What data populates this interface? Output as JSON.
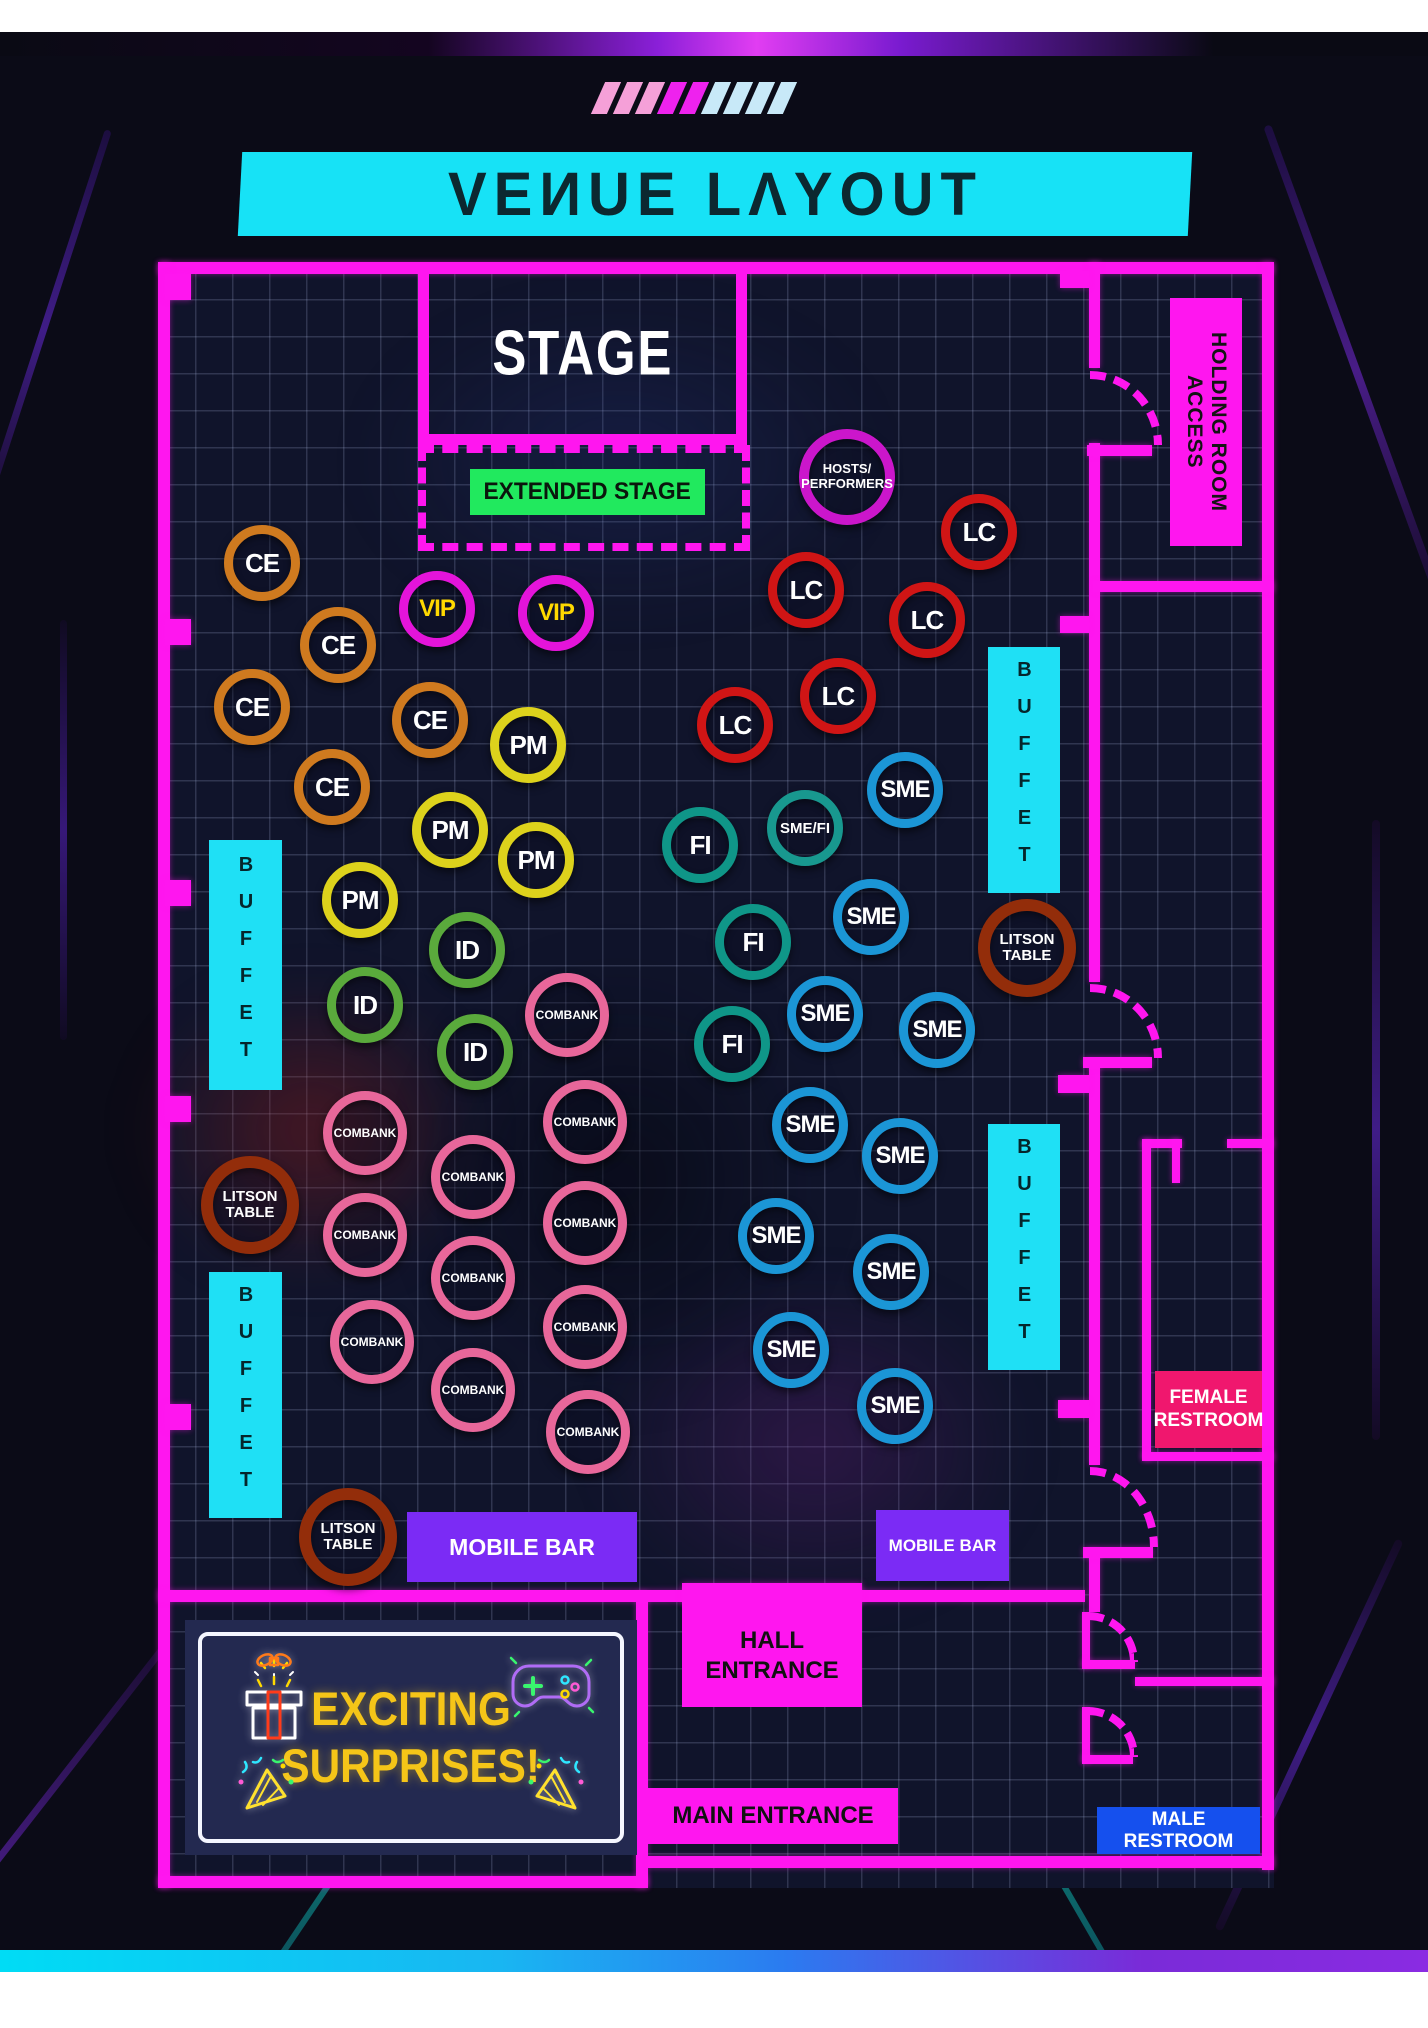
{
  "header": {
    "title": "VEИUE LΛYOUT",
    "slash_colors": [
      "#f5a0d8",
      "#f5a0d8",
      "#f5a0d8",
      "#ee22ee",
      "#ee22ee",
      "#c8e9f8",
      "#c8e9f8",
      "#c8e9f8",
      "#c8e9f8"
    ]
  },
  "colors": {
    "wall": "#ff16ef",
    "buffet_cyan": "#1fe0f5",
    "stage_green": "#21e95e",
    "mobile_bar_purple": "#7b2bf5",
    "female_pink": "#f0176e",
    "male_blue": "#1550ee",
    "banner_yellow": "#f5c518"
  },
  "venue": {
    "stage_label": "STAGE",
    "extended_stage_label": "EXTENDED STAGE",
    "holding_room_label": "HOLDING ROOM ACCESS",
    "buffet_label": "BUFFET",
    "mobile_bar_label": "MOBILE BAR",
    "hall_entrance_label": "HALL\nENTRANCE",
    "main_entrance_label": "MAIN ENTRANCE",
    "female_restroom_label": "FEMALE\nRESTROOM",
    "male_restroom_label": "MALE RESTROOM"
  },
  "banner": {
    "line1": "EXCITING",
    "line2": "SURPRISES!"
  },
  "tables": [
    {
      "type": "ce",
      "label": "CE",
      "x": 262,
      "y": 563
    },
    {
      "type": "ce",
      "label": "CE",
      "x": 338,
      "y": 645
    },
    {
      "type": "ce",
      "label": "CE",
      "x": 252,
      "y": 707
    },
    {
      "type": "ce",
      "label": "CE",
      "x": 430,
      "y": 720
    },
    {
      "type": "ce",
      "label": "CE",
      "x": 332,
      "y": 787
    },
    {
      "type": "vip",
      "label": "VIP",
      "x": 437,
      "y": 609
    },
    {
      "type": "vip",
      "label": "VIP",
      "x": 556,
      "y": 613
    },
    {
      "type": "pm",
      "label": "PM",
      "x": 528,
      "y": 745
    },
    {
      "type": "pm",
      "label": "PM",
      "x": 450,
      "y": 830
    },
    {
      "type": "pm",
      "label": "PM",
      "x": 536,
      "y": 860
    },
    {
      "type": "pm",
      "label": "PM",
      "x": 360,
      "y": 900
    },
    {
      "type": "id",
      "label": "ID",
      "x": 467,
      "y": 950
    },
    {
      "type": "id",
      "label": "ID",
      "x": 365,
      "y": 1005
    },
    {
      "type": "id",
      "label": "ID",
      "x": 475,
      "y": 1052
    },
    {
      "type": "lc",
      "label": "LC",
      "x": 979,
      "y": 532
    },
    {
      "type": "lc",
      "label": "LC",
      "x": 806,
      "y": 590
    },
    {
      "type": "lc",
      "label": "LC",
      "x": 927,
      "y": 620
    },
    {
      "type": "lc",
      "label": "LC",
      "x": 838,
      "y": 696
    },
    {
      "type": "lc",
      "label": "LC",
      "x": 735,
      "y": 725
    },
    {
      "type": "fi",
      "label": "FI",
      "x": 700,
      "y": 845
    },
    {
      "type": "fi",
      "label": "FI",
      "x": 753,
      "y": 942
    },
    {
      "type": "fi",
      "label": "FI",
      "x": 732,
      "y": 1044
    },
    {
      "type": "smefi",
      "label": "SME/FI",
      "x": 805,
      "y": 828
    },
    {
      "type": "sme",
      "label": "SME",
      "x": 905,
      "y": 790
    },
    {
      "type": "sme",
      "label": "SME",
      "x": 871,
      "y": 917
    },
    {
      "type": "sme",
      "label": "SME",
      "x": 825,
      "y": 1014
    },
    {
      "type": "sme",
      "label": "SME",
      "x": 937,
      "y": 1030
    },
    {
      "type": "sme",
      "label": "SME",
      "x": 810,
      "y": 1125
    },
    {
      "type": "sme",
      "label": "SME",
      "x": 900,
      "y": 1156
    },
    {
      "type": "sme",
      "label": "SME",
      "x": 776,
      "y": 1236
    },
    {
      "type": "sme",
      "label": "SME",
      "x": 891,
      "y": 1272
    },
    {
      "type": "sme",
      "label": "SME",
      "x": 791,
      "y": 1350
    },
    {
      "type": "sme",
      "label": "SME",
      "x": 895,
      "y": 1406
    },
    {
      "type": "combank",
      "label": "COMBANK",
      "x": 567,
      "y": 1015
    },
    {
      "type": "combank",
      "label": "COMBANK",
      "x": 365,
      "y": 1133
    },
    {
      "type": "combank",
      "label": "COMBANK",
      "x": 585,
      "y": 1122
    },
    {
      "type": "combank",
      "label": "COMBANK",
      "x": 473,
      "y": 1177
    },
    {
      "type": "combank",
      "label": "COMBANK",
      "x": 365,
      "y": 1235
    },
    {
      "type": "combank",
      "label": "COMBANK",
      "x": 585,
      "y": 1223
    },
    {
      "type": "combank",
      "label": "COMBANK",
      "x": 473,
      "y": 1278
    },
    {
      "type": "combank",
      "label": "COMBANK",
      "x": 372,
      "y": 1342
    },
    {
      "type": "combank",
      "label": "COMBANK",
      "x": 585,
      "y": 1327
    },
    {
      "type": "combank",
      "label": "COMBANK",
      "x": 473,
      "y": 1390
    },
    {
      "type": "combank",
      "label": "COMBANK",
      "x": 588,
      "y": 1432
    },
    {
      "type": "litson",
      "label": "LITSON\nTABLE",
      "x": 250,
      "y": 1205
    },
    {
      "type": "litson",
      "label": "LITSON\nTABLE",
      "x": 348,
      "y": 1537
    },
    {
      "type": "litson",
      "label": "LITSON\nTABLE",
      "x": 1027,
      "y": 948
    },
    {
      "type": "hosts",
      "label": "HOSTS/\nPERFORMERS",
      "x": 847,
      "y": 477
    }
  ]
}
